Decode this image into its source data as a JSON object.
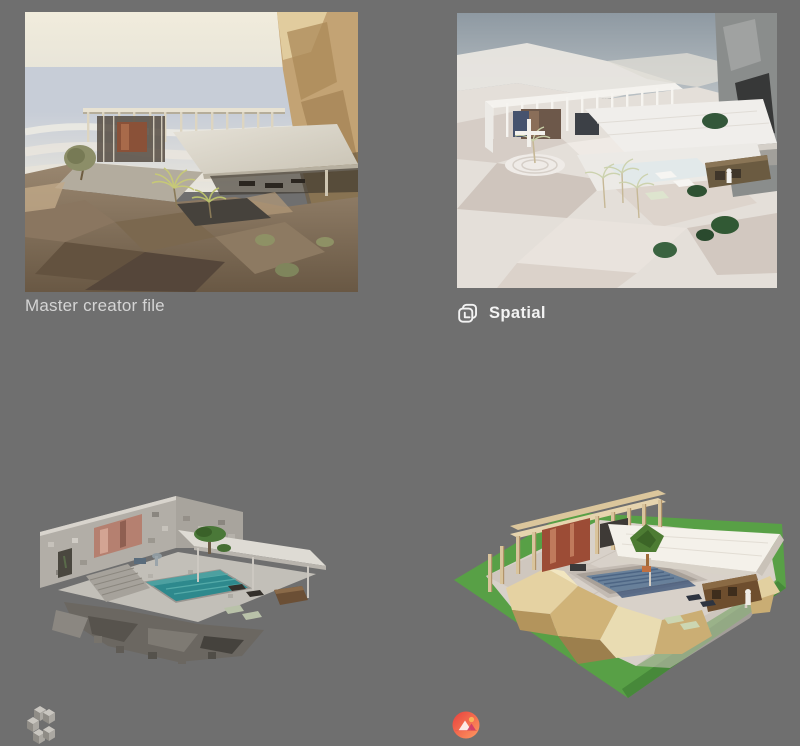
{
  "page": {
    "background_color": "#6f6f6f"
  },
  "gallery": {
    "master": {
      "caption": "Master creator file",
      "alt": "photorealistic render of cliffside villa with pergola, palms and rocks"
    },
    "spatial": {
      "caption": "Spatial",
      "icon": "spatial-logo-icon",
      "alt": "pale stylized render of the same villa in Spatial"
    },
    "voxel": {
      "icon": "voxel-cubes-logo-icon",
      "alt": "gray voxel block version of the villa with teal pool"
    },
    "lowpoly": {
      "icon": "red-circle-pyramids-logo-icon",
      "alt": "low-poly version of the villa on green ground with tan rocks"
    }
  },
  "colors": {
    "background": "#6f6f6f",
    "caption_text": "#d4d4d4",
    "brand_text": "#f3f3f3",
    "voxel_pool_teal": "#2e898d",
    "lowpoly_grass_green": "#58a046",
    "lowpoly_pool_blue": "#68809a",
    "logo_gradient_red": "#e8403d",
    "logo_gradient_orange": "#ff9a61"
  }
}
